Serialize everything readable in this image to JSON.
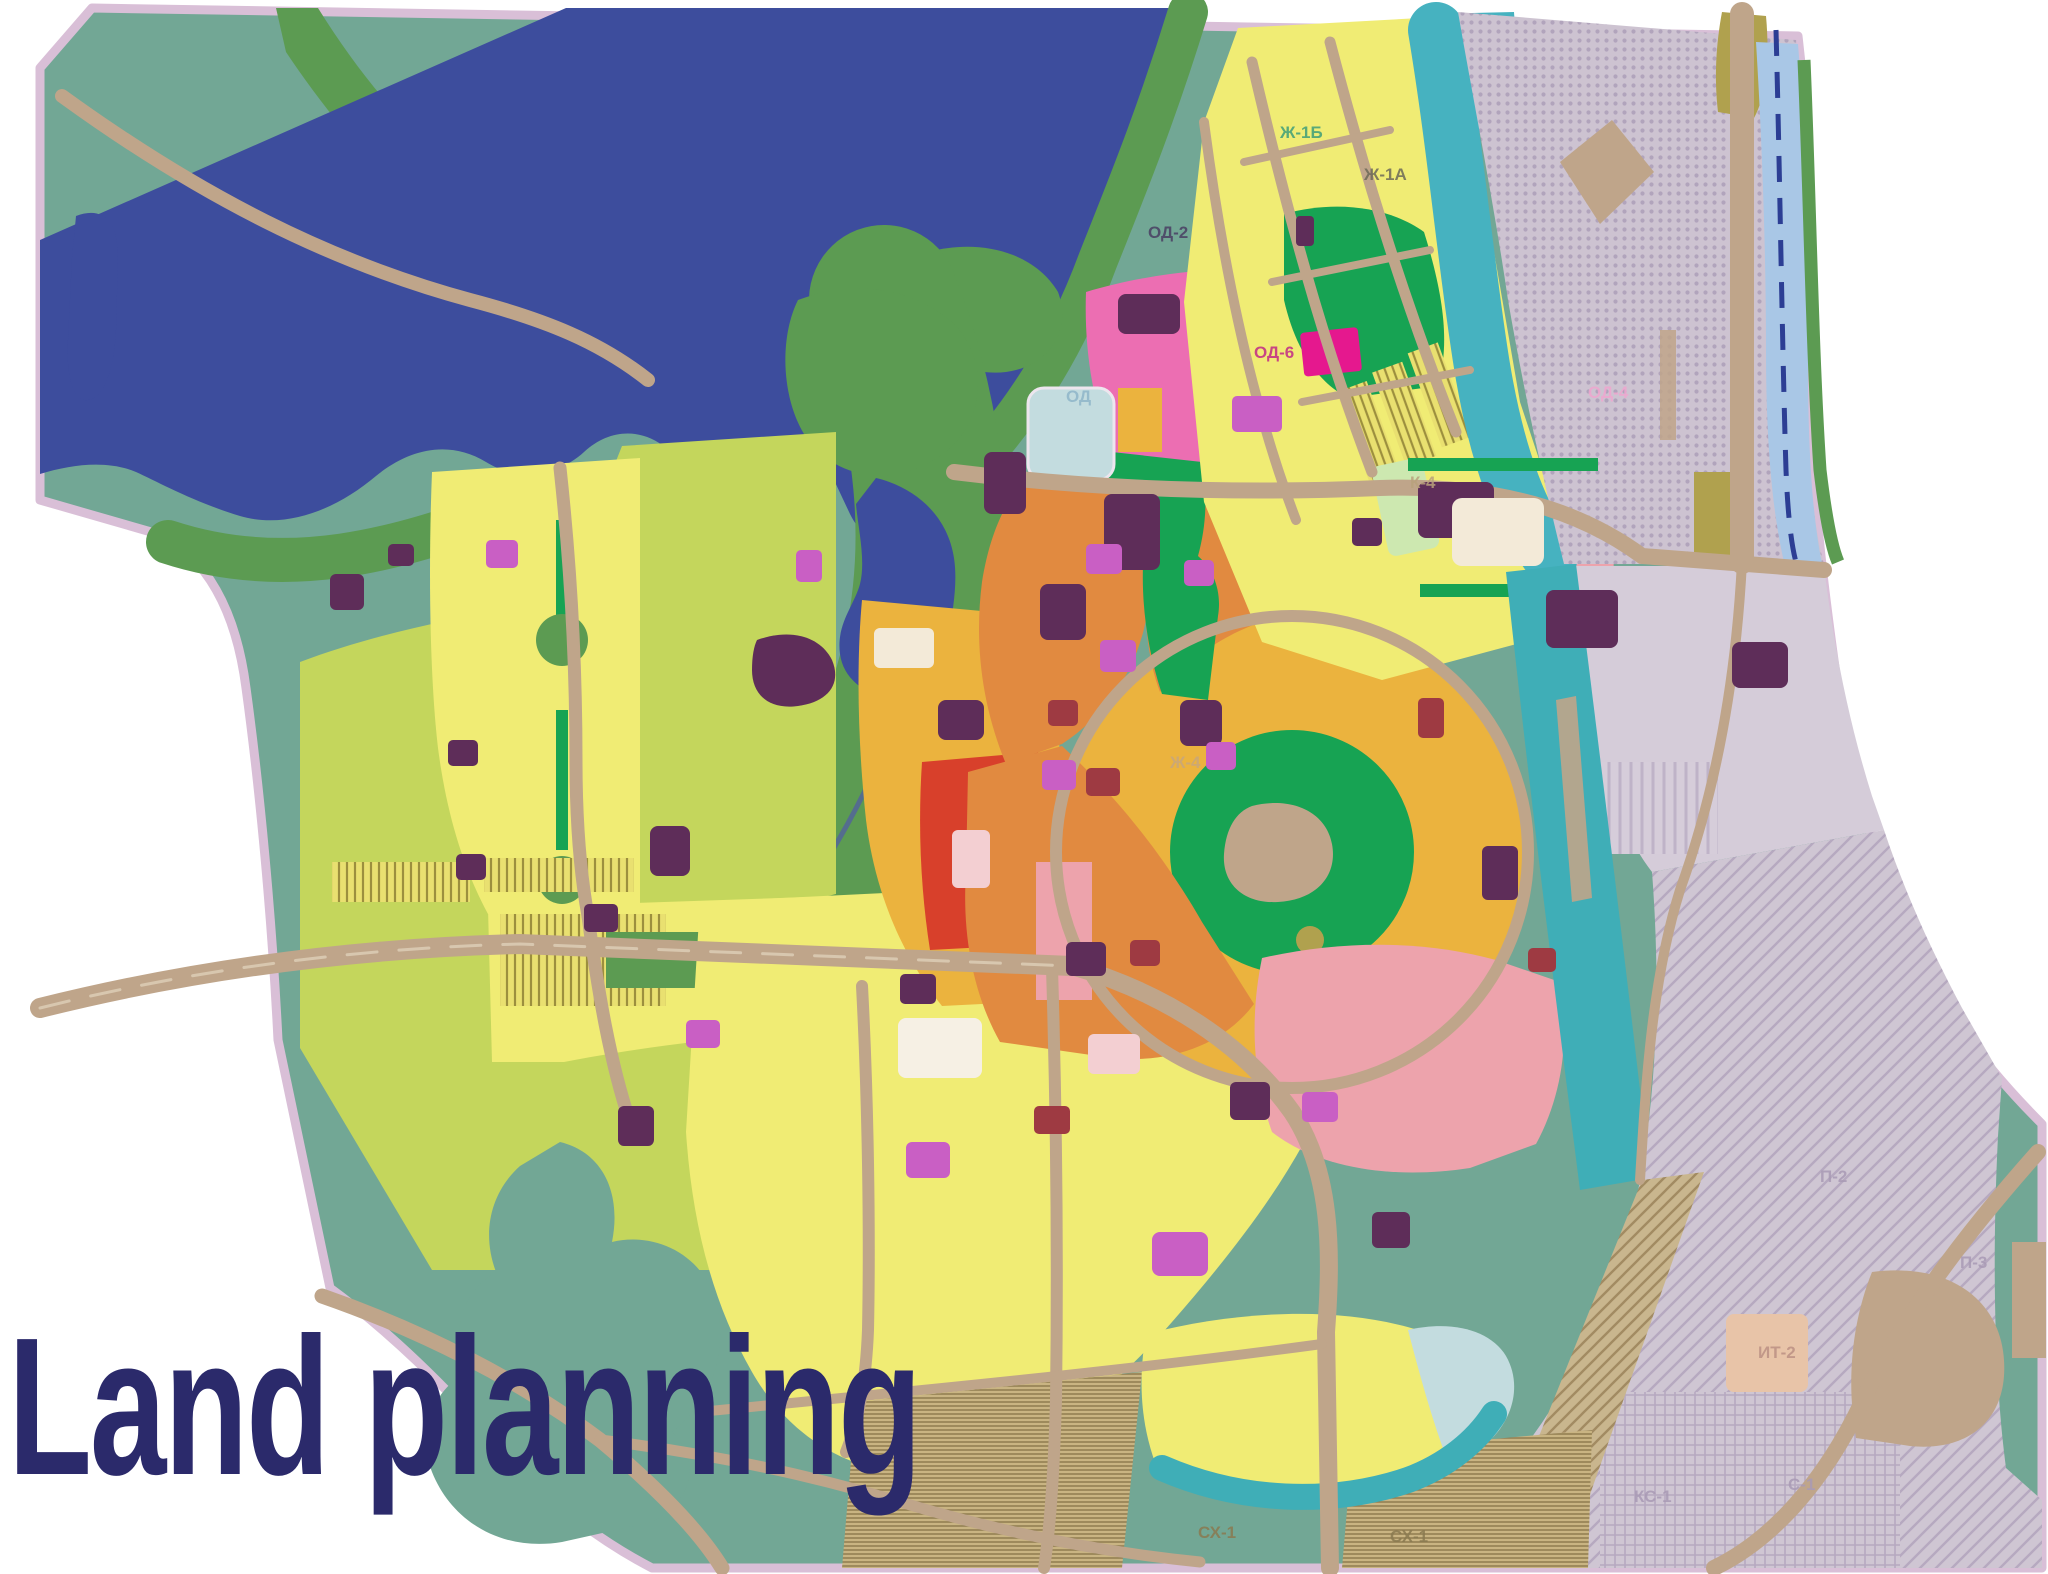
{
  "title": {
    "text": "Land planning",
    "color": "#2B2A6B"
  },
  "map": {
    "description": "City land-use zoning plan with bay, parks, residential, industrial and agricultural zones",
    "boundary_color": "#D9BFD7",
    "road_color": "#BFA58A",
    "legend_colors": {
      "water": "#3D4D9D",
      "natural_landscape": "#72A795",
      "forest": "#5C9B52",
      "park": "#17A353",
      "residential_yellow": "#F0EC74",
      "agricultural_lime": "#C4D65C",
      "residential_orange": "#E18A40",
      "mixed_amber": "#EBB33E",
      "public_pink": "#EC6EB2",
      "public_magenta": "#E5188E",
      "salmon": "#EDA3AC",
      "special_purple": "#5E2D59",
      "mixed_violet": "#C95FC4",
      "dark_red": "#9E3A42",
      "lake_pale_blue": "#C3DCDF",
      "canal_teal": "#3FAEB7",
      "lagoon_teal": "#46B2C0",
      "river_light_blue": "#A9C7E6",
      "industrial_lavender": "#CDC3D1",
      "garden_olive": "#B0A14E",
      "garden_tan": "#C9B482"
    },
    "zone_labels": [
      {
        "text": "ОД",
        "x": 1066,
        "y": 402,
        "color": "#8fb6c9"
      },
      {
        "text": "ОД-2",
        "x": 1148,
        "y": 238,
        "color": "#4a3f63"
      },
      {
        "text": "ОД-6",
        "x": 1254,
        "y": 358,
        "color": "#c22a86"
      },
      {
        "text": "ОД-4",
        "x": 1588,
        "y": 398,
        "color": "#f0a6cf"
      },
      {
        "text": "Ж-1Б",
        "x": 1280,
        "y": 138,
        "color": "#3f9e79"
      },
      {
        "text": "Ж-1А",
        "x": 1364,
        "y": 180,
        "color": "#6d6a58"
      },
      {
        "text": "К-4",
        "x": 1410,
        "y": 488,
        "color": "#b9a27c"
      },
      {
        "text": "Ж-4",
        "x": 1170,
        "y": 768,
        "color": "#c8a77c"
      },
      {
        "text": "СХ-1",
        "x": 1198,
        "y": 1538,
        "color": "#8a7a50"
      },
      {
        "text": "СХ-1",
        "x": 1390,
        "y": 1542,
        "color": "#8a7a50"
      },
      {
        "text": "П-2",
        "x": 1820,
        "y": 1182,
        "color": "#a99ab5"
      },
      {
        "text": "П-3",
        "x": 1960,
        "y": 1268,
        "color": "#a99ab5"
      },
      {
        "text": "ИТ-2",
        "x": 1758,
        "y": 1358,
        "color": "#bc9184"
      },
      {
        "text": "КС-1",
        "x": 1634,
        "y": 1502,
        "color": "#a99ab5"
      },
      {
        "text": "С-1",
        "x": 1788,
        "y": 1490,
        "color": "#a99ab5"
      }
    ]
  }
}
